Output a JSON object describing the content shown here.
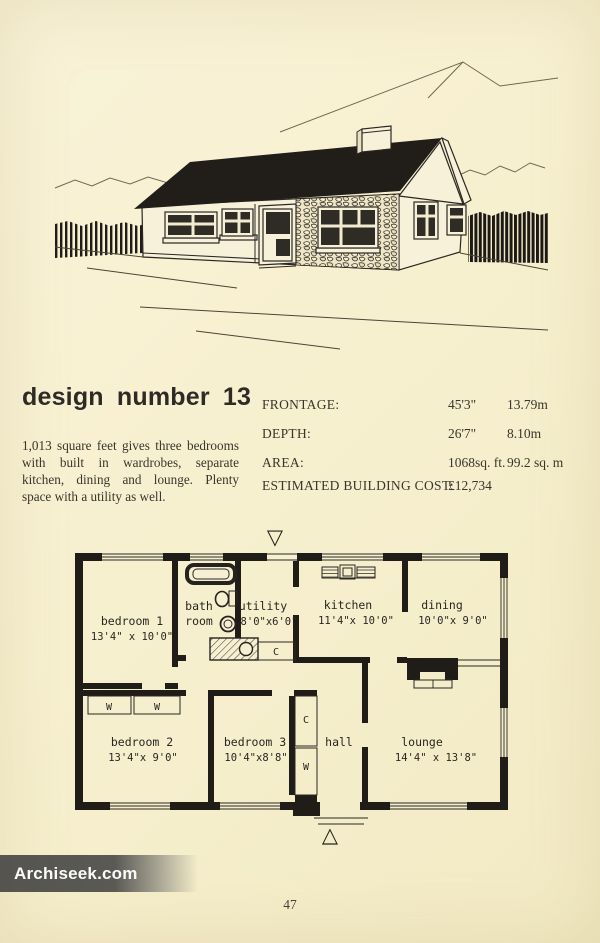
{
  "page": {
    "number": "47",
    "watermark": "Archiseek.com"
  },
  "title": "design number 13",
  "description": {
    "lines": [
      "1,013 square feet gives three bedrooms",
      "with built in wardrobes, separate",
      "kitchen, dining and lounge. Plenty",
      "space with a utility as well."
    ]
  },
  "specs": {
    "rows": [
      {
        "label": "FRONTAGE:",
        "imperial": "45'3\"",
        "metric": "13.79m"
      },
      {
        "label": "DEPTH:",
        "imperial": "26'7\"",
        "metric": "8.10m"
      },
      {
        "label": "AREA:",
        "imperial": "1068sq. ft.",
        "metric": "99.2 sq. m"
      },
      {
        "label": "ESTIMATED BUILDING COST:",
        "imperial": "£12,734",
        "metric": ""
      }
    ]
  },
  "floor_plan": {
    "rooms": [
      {
        "name": "bedroom 1",
        "dims": "13'4\" x 10'0\""
      },
      {
        "name": "bath",
        "name2": "room"
      },
      {
        "name": "utility",
        "dims": "8'0\"x6'0\""
      },
      {
        "name": "kitchen",
        "dims": "11'4\"x 10'0\""
      },
      {
        "name": "dining",
        "dims": "10'0\"x 9'0\""
      },
      {
        "name": "bedroom 2",
        "dims": "13'4\"x 9'0\""
      },
      {
        "name": "bedroom 3",
        "dims": "10'4\"x8'8\""
      },
      {
        "name": "hall"
      },
      {
        "name": "lounge",
        "dims": "14'4\" x 13'8\""
      }
    ],
    "wardrobe_label": "W",
    "cupboard_label": "C",
    "marker_down": "▽",
    "marker_up": "△"
  }
}
